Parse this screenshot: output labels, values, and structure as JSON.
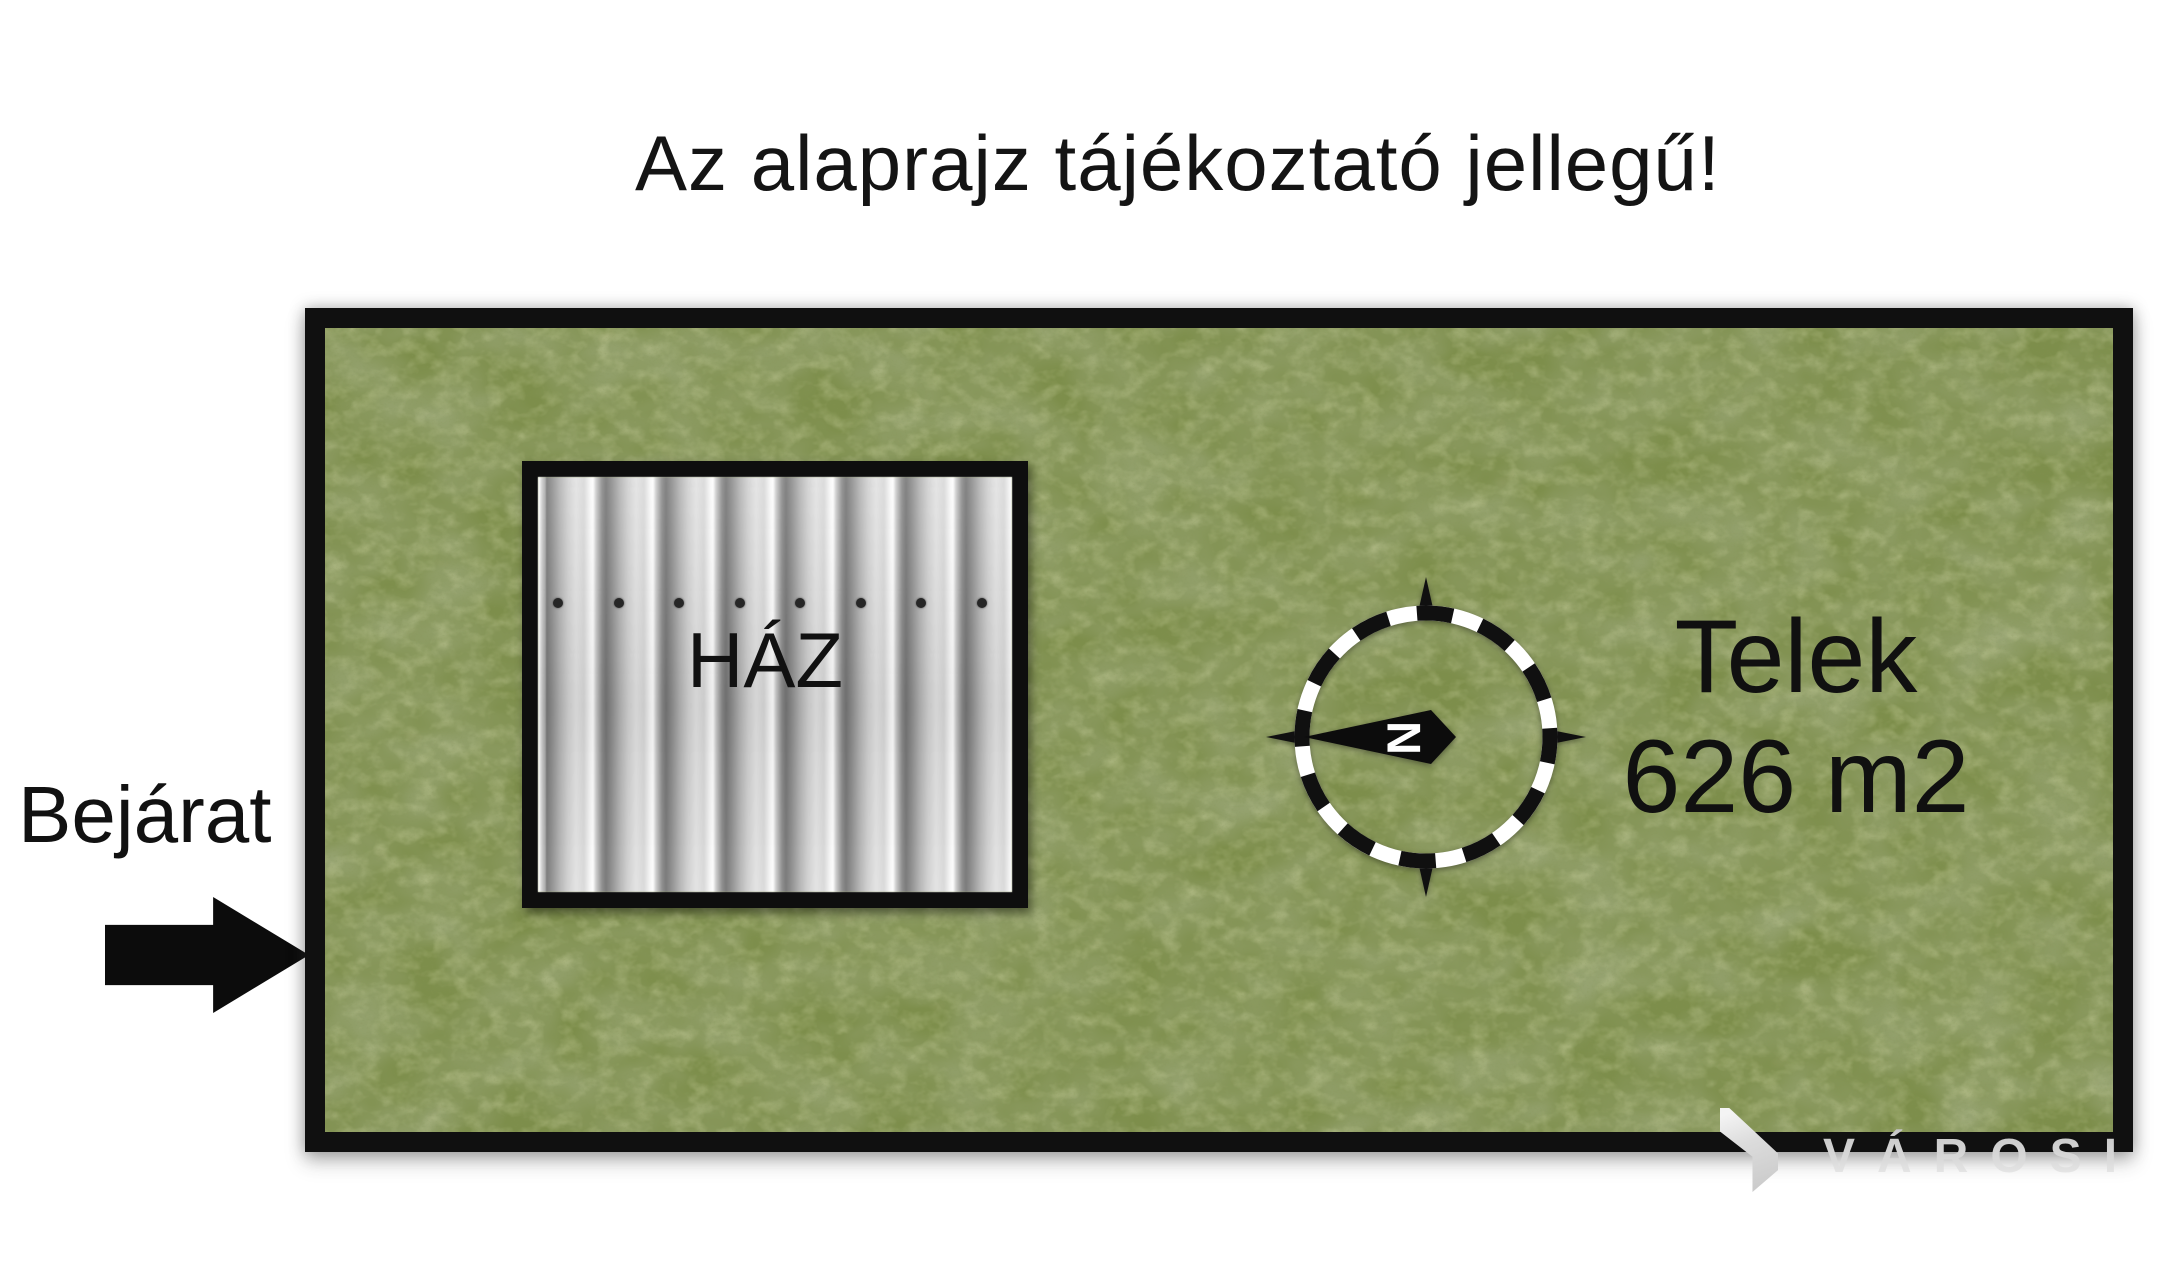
{
  "page": {
    "background_color": "#ffffff",
    "title": "Az alaprajz tájékoztató jellegű!"
  },
  "plot": {
    "label": "Telek",
    "area": "626 m2",
    "grass_color": "#7d8e4b",
    "border_color": "#101010"
  },
  "house": {
    "label": "HÁZ",
    "roof_screw_count": 8
  },
  "compass": {
    "north_letter": "N"
  },
  "entrance": {
    "label": "Bejárat"
  },
  "watermark": {
    "text": "VÁROSI",
    "color": "#d7d7d7"
  },
  "icons": {
    "entrance_arrow": "right-arrow",
    "compass": "compass-rose",
    "watermark_logo": "house-logo"
  }
}
